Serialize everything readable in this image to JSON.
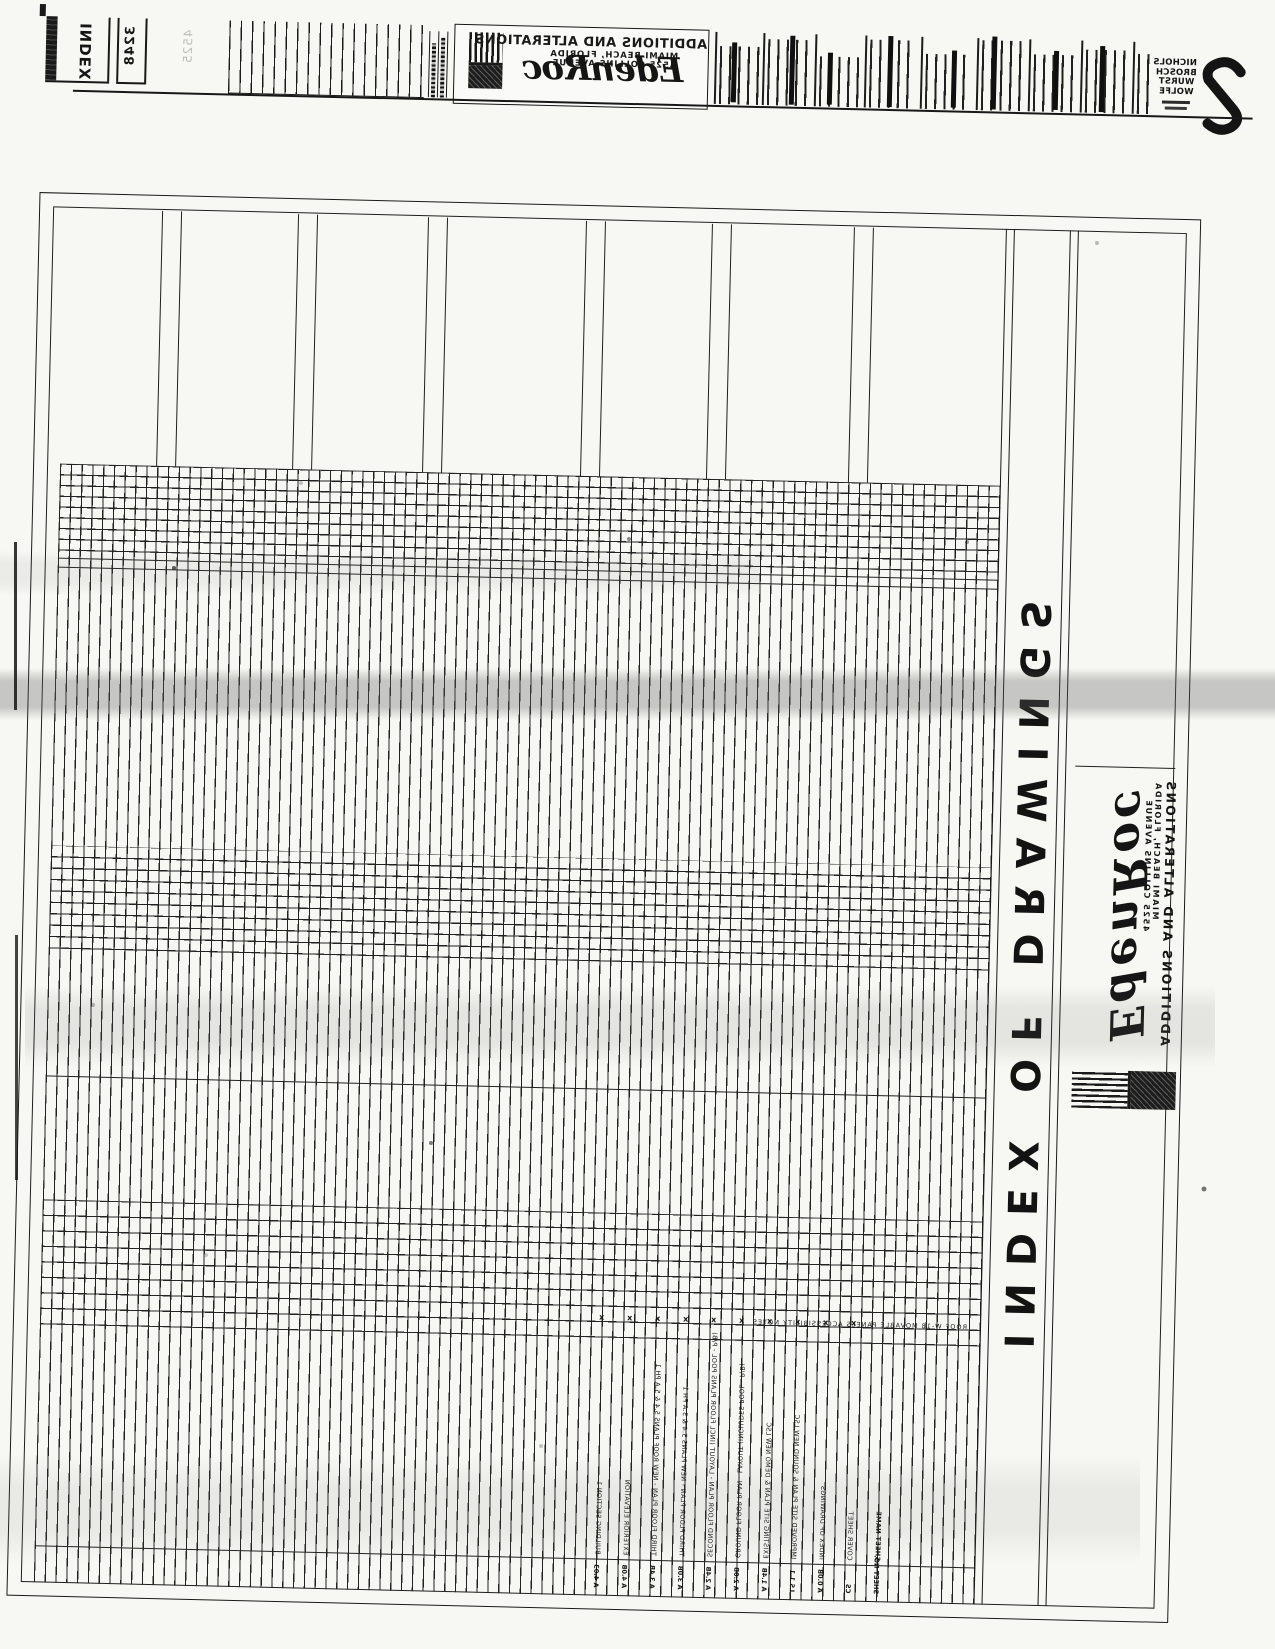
{
  "tabs": {
    "index": "INDEX",
    "number": "3248",
    "faint_stamp": "4525"
  },
  "project": {
    "name": "ADDITIONS AND ALTERATIONS",
    "location": "MIAMI BEACH, FLORIDA",
    "address": "4525 COLLINS AVENUE",
    "brand": "EdenRoc"
  },
  "firm": {
    "name_lines": [
      "NICHOLS",
      "BROSCH",
      "WURST",
      "WOLFE"
    ]
  },
  "sheet": {
    "title": "INDEX OF DRAWINGS",
    "note": "ROOF W-18  MOVABLE PANELS  ACCESSIBILITY NOTES",
    "revision_mark": "x",
    "stamp": {
      "project": "ADDITIONS AND ALTERATIONS",
      "location": "MIAMI BEACH, FLORIDA",
      "address": "4525 COLLINS AVENUE",
      "brand": "EdenRoc"
    },
    "rows": [
      {
        "name": "BUILDING SECTION 1",
        "number": "A 4.03"
      },
      {
        "name": "EXTERIOR ELEVATION",
        "number": "A 4.0B"
      },
      {
        "name": "THIRD FLOOR PLAN - NEW ROOF PLANS   5.4 & 5.A PH 1",
        "number": "A 3.4B"
      },
      {
        "name": "THIRD FLOOR PLAN - NEW PLANS   5.4 & 5.A PH 1",
        "number": "A 3.0B"
      },
      {
        "name": "SECOND FLOOR PLAN - LAYOUT (INCL FLOOR PLANS  POOL - P/B)",
        "number": "A 2.4B"
      },
      {
        "name": "GROUND FLOOR PLAN - LAYOUT (INCLUDES POOL - P/B)",
        "number": "A 2.0B"
      },
      {
        "name": "EXISTING SITE PLAN & DEMO NEW LSC",
        "number": "A 1.4B"
      },
      {
        "name": "IMPROVED SITE PLAN & SOUND NEW LSC",
        "number": "LS 1.1"
      },
      {
        "name": "INDEX OF DRAWINGS",
        "number": "A 0.0B"
      },
      {
        "name": "COVER SHEET",
        "number": "CS"
      },
      {
        "name": "SHEET NAME",
        "number": "SHEET NO."
      }
    ]
  },
  "colors": {
    "ink": "#1a1a1a",
    "paper": "#f7f7f3"
  }
}
